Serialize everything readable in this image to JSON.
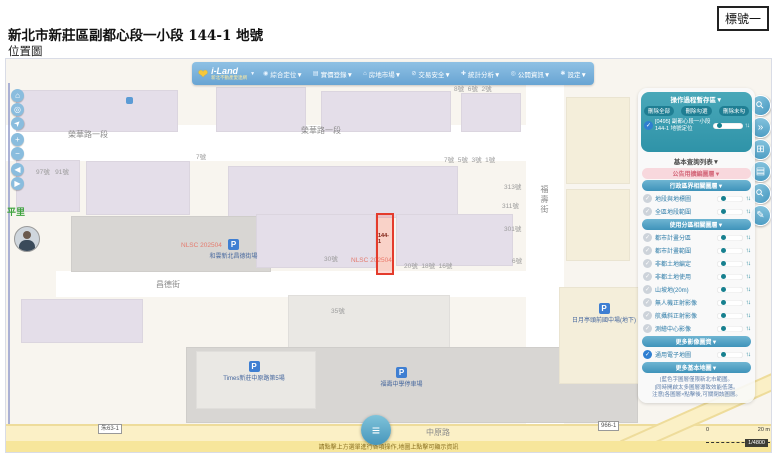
{
  "ui": {
    "check": "✓",
    "updown": "↑↓",
    "heart": "❤",
    "menu_glyph": "≡",
    "parking": "P"
  },
  "page": {
    "tag_label": "標號一",
    "title": "新北市新莊區副都心段一小段 144-1 地號",
    "subtitle": "位置圖"
  },
  "navbar": {
    "logo": {
      "brand": "i-Land",
      "sub": "新北不動產愛連網",
      "caret": "▼"
    },
    "menus": [
      {
        "icon": "◉",
        "label": "綜合定位▼"
      },
      {
        "icon": "▤",
        "label": "實價登錄▼"
      },
      {
        "icon": "⌂",
        "label": "房地市場▼"
      },
      {
        "icon": "⊘",
        "label": "交易安全▼"
      },
      {
        "icon": "✚",
        "label": "統計分析▼"
      },
      {
        "icon": "◎",
        "label": "公開資訊▼"
      },
      {
        "icon": "✱",
        "label": "設定▼"
      }
    ]
  },
  "left_controls": [
    {
      "glyph": "⌂",
      "name": "home-button",
      "y": 30
    },
    {
      "glyph": "◎",
      "name": "locate-button",
      "y": 44
    },
    {
      "glyph": "➤",
      "name": "compass-button",
      "y": 58,
      "cls": "rot45"
    },
    {
      "glyph": "+",
      "name": "zoom-in-button",
      "y": 74
    },
    {
      "glyph": "−",
      "name": "zoom-out-button",
      "y": 88
    },
    {
      "glyph": "◀",
      "name": "pan-left-button",
      "y": 104
    },
    {
      "glyph": "▶",
      "name": "pan-right-button",
      "y": 118
    }
  ],
  "right_controls": [
    {
      "glyph": "⚲",
      "name": "search-icon",
      "y": 36,
      "cls": "rot45"
    },
    {
      "glyph": "»",
      "name": "collapse-panel-icon",
      "y": 58
    },
    {
      "glyph": "⊞",
      "name": "add-frame-icon",
      "y": 80
    },
    {
      "glyph": "▤",
      "name": "layer-list-icon",
      "y": 102
    },
    {
      "glyph": "⚲",
      "name": "zoom-search-icon",
      "y": 124,
      "cls": "rot45"
    },
    {
      "glyph": "✎",
      "name": "draw-icon",
      "y": 146
    }
  ],
  "map": {
    "blocks": [
      {
        "x": 0,
        "y": 66,
        "w": 552,
        "h": 36,
        "c": "white"
      },
      {
        "x": 520,
        "y": 24,
        "w": 38,
        "h": 342,
        "c": "white"
      },
      {
        "x": 50,
        "y": 212,
        "w": 472,
        "h": 26,
        "c": "white"
      },
      {
        "x": 10,
        "y": 31,
        "w": 160,
        "h": 40,
        "c": "lav"
      },
      {
        "x": 210,
        "y": 28,
        "w": 88,
        "h": 43,
        "c": "lav"
      },
      {
        "x": 315,
        "y": 32,
        "w": 128,
        "h": 39,
        "c": "lav"
      },
      {
        "x": 455,
        "y": 34,
        "w": 58,
        "h": 37,
        "c": "lav"
      },
      {
        "x": 560,
        "y": 38,
        "w": 62,
        "h": 85,
        "c": "cream"
      },
      {
        "x": 10,
        "y": 101,
        "w": 62,
        "h": 50,
        "c": "lav"
      },
      {
        "x": 80,
        "y": 102,
        "w": 102,
        "h": 52,
        "c": "lav"
      },
      {
        "x": 222,
        "y": 107,
        "w": 228,
        "h": 50,
        "c": "lav"
      },
      {
        "x": 65,
        "y": 157,
        "w": 198,
        "h": 54,
        "c": "gray"
      },
      {
        "x": 250,
        "y": 155,
        "w": 118,
        "h": 52,
        "c": "lav"
      },
      {
        "x": 390,
        "y": 155,
        "w": 115,
        "h": 50,
        "c": "lav"
      },
      {
        "x": 560,
        "y": 130,
        "w": 62,
        "h": 70,
        "c": "cream"
      },
      {
        "x": 15,
        "y": 240,
        "w": 120,
        "h": 42,
        "c": "lav"
      },
      {
        "x": 282,
        "y": 236,
        "w": 160,
        "h": 54,
        "c": "lgray"
      },
      {
        "x": 180,
        "y": 288,
        "w": 450,
        "h": 74,
        "c": "gray"
      },
      {
        "x": 190,
        "y": 292,
        "w": 118,
        "h": 56,
        "c": "lgray"
      },
      {
        "x": 553,
        "y": 228,
        "w": 78,
        "h": 95,
        "c": "cream"
      }
    ],
    "street_labels": [
      {
        "text": "榮華路一段",
        "x": 62,
        "y": 70
      },
      {
        "text": "榮華路一段",
        "x": 295,
        "y": 66
      },
      {
        "text": "福壽街",
        "x": 533,
        "y": 126,
        "vertical": true
      },
      {
        "text": "昌德街",
        "x": 150,
        "y": 220
      },
      {
        "text": "中原路",
        "x": 420,
        "y": 368
      }
    ],
    "area_label": "平里",
    "house_numbers": [
      {
        "text": "8號  6號  2號",
        "x": 448,
        "y": 24
      },
      {
        "text": "7號",
        "x": 190,
        "y": 92
      },
      {
        "text": "97號   91號",
        "x": 30,
        "y": 107
      },
      {
        "text": "7號  5號  3號  1號",
        "x": 438,
        "y": 95
      },
      {
        "text": "313號",
        "x": 498,
        "y": 122
      },
      {
        "text": "311號",
        "x": 496,
        "y": 141
      },
      {
        "text": "301號",
        "x": 498,
        "y": 164
      },
      {
        "text": "6號",
        "x": 506,
        "y": 196
      },
      {
        "text": "30號",
        "x": 318,
        "y": 194
      },
      {
        "text": "20號  18號  16號",
        "x": 398,
        "y": 201
      },
      {
        "text": "35號",
        "x": 325,
        "y": 246
      }
    ],
    "parkings": [
      {
        "label": "和雲新北昌德街場",
        "x": 180,
        "y": 180,
        "w": 95
      },
      {
        "label": "Times新莊中原路第5場",
        "x": 188,
        "y": 302,
        "w": 120
      },
      {
        "label": "福壽中學停車場",
        "x": 348,
        "y": 308,
        "w": 95
      },
      {
        "label": "日月亭頭前國中場(地下)",
        "x": 538,
        "y": 244,
        "w": 120
      }
    ],
    "watermarks": [
      {
        "text": "NLSC 202504",
        "x": 175,
        "y": 183
      },
      {
        "text": "NLSC 202504",
        "x": 345,
        "y": 198
      }
    ],
    "parcel": {
      "label": "144-1",
      "x": 370,
      "y": 154,
      "w": 14,
      "h": 58
    },
    "road_badges": [
      {
        "text": "朱63-1",
        "x": 92,
        "y": 365
      },
      {
        "text": "966-1",
        "x": 592,
        "y": 362
      }
    ],
    "scale": {
      "zero": "0",
      "dist": "20 m",
      "ratio": "1/4800"
    },
    "attribution": "請點擊上方選單進行各項操作,地圖上點擊可顯示資訊"
  },
  "sidebar": {
    "temp_panel": {
      "title": "操作過程暫存區▼",
      "buttons": [
        "刪除全部",
        "刪除勾選",
        "刪除未勾"
      ],
      "item": "[0495] 副都心段一小段144-1 地號定位"
    },
    "rows": [
      {
        "t": "text",
        "label": "基本查詢列表▼"
      },
      {
        "t": "pink",
        "label": "公告用擴編圖層▼"
      },
      {
        "t": "hdr",
        "label": "行政區界相關圖層▼"
      },
      {
        "t": "row",
        "label": "地段與地標圖"
      },
      {
        "t": "row",
        "label": "全區地段範圍"
      },
      {
        "t": "hdr",
        "label": "使用分區相關圖層▼"
      },
      {
        "t": "row",
        "label": "都市計畫分區"
      },
      {
        "t": "row",
        "label": "都市計畫範圍"
      },
      {
        "t": "row",
        "label": "非都土地編定"
      },
      {
        "t": "row",
        "label": "非都土地使用"
      },
      {
        "t": "row",
        "label": "山坡地(20m)"
      },
      {
        "t": "row",
        "label": "無人機正射影像"
      },
      {
        "t": "row",
        "label": "航攝斜正射影像"
      },
      {
        "t": "row",
        "label": "測繪中心影像"
      },
      {
        "t": "hdr",
        "label": "更多影像圖資▼"
      },
      {
        "t": "row",
        "label": "通用電子地圖",
        "checked": true
      },
      {
        "t": "hdr",
        "label": "更多基本地圖▼"
      }
    ],
    "notes": [
      "|藍色字圖層僅限新北市範圍。",
      "|同時開啟太多圖層導致效能低落。",
      "注意|各圖層×點擊後,可關閉該圖層。"
    ]
  }
}
